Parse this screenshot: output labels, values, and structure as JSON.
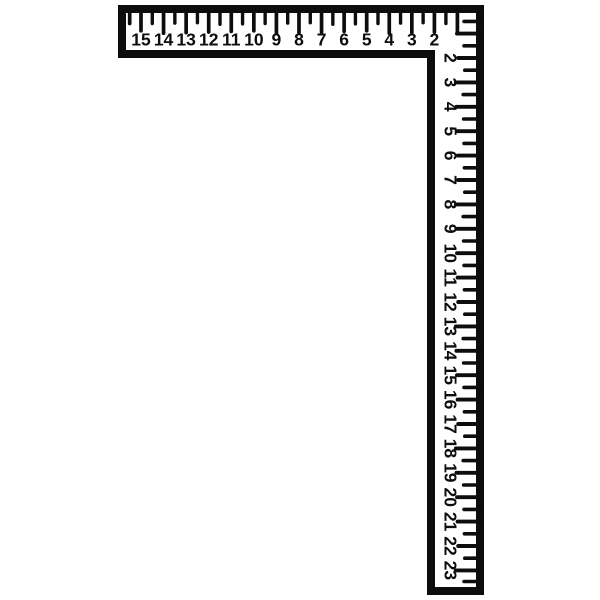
{
  "figure": {
    "name": "carpenter-framing-square",
    "background_color": "#ffffff",
    "ink_color": "#0d0d0d"
  },
  "horizontal_scale": {
    "unit_labels": [
      "15",
      "14",
      "13",
      "12",
      "11",
      "10",
      "9",
      "8",
      "7",
      "6",
      "5",
      "4",
      "3",
      "2"
    ]
  },
  "vertical_scale": {
    "unit_labels": [
      "2",
      "3",
      "4",
      "5",
      "6",
      "7",
      "8",
      "9",
      "10",
      "11",
      "12",
      "13",
      "14",
      "15",
      "16",
      "17",
      "18",
      "19",
      "20",
      "21",
      "22",
      "23"
    ]
  }
}
